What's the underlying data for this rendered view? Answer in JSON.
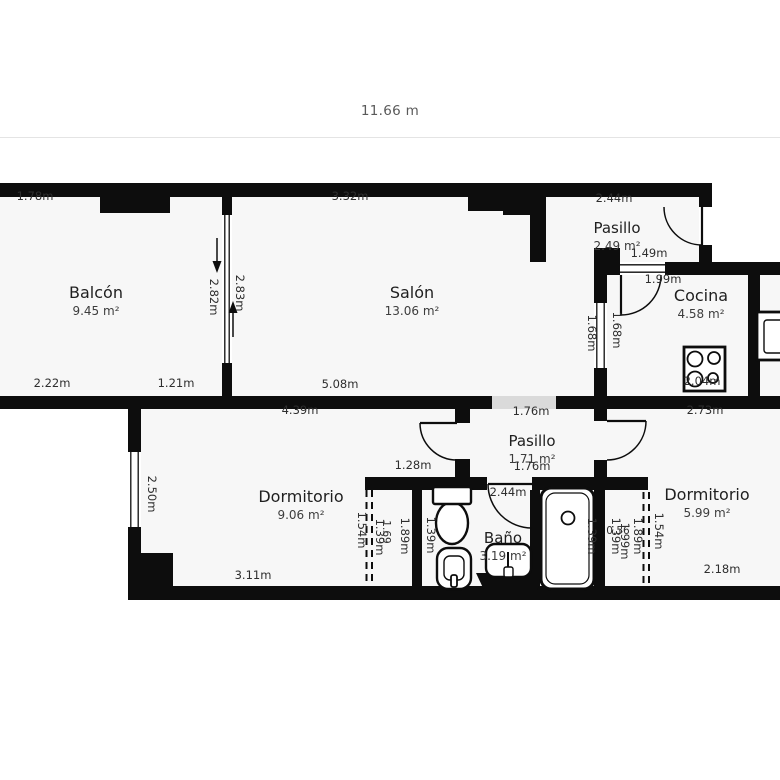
{
  "scale": {
    "label": "11.66 m"
  },
  "colors": {
    "wall": "#0d0d0d",
    "room_fill": "#f7f7f7",
    "background": "#ffffff",
    "opening": "#dadada",
    "dim_text": "#2e2e2e",
    "scale_line": "#e4e4e4",
    "scale_text": "#5a5a5a"
  },
  "plan": {
    "fills": [
      [
        0,
        196,
        712,
        200
      ],
      [
        594,
        262,
        186,
        141
      ],
      [
        128,
        396,
        652,
        204
      ]
    ],
    "opening": [
      492,
      396,
      64,
      13
    ],
    "walls": [
      [
        0,
        183,
        712,
        14
      ],
      [
        100,
        196,
        70,
        17
      ],
      [
        468,
        183,
        78,
        28
      ],
      [
        503,
        197,
        43,
        18
      ],
      [
        530,
        197,
        16,
        65
      ],
      [
        222,
        197,
        10,
        199
      ],
      [
        699,
        183,
        13,
        92
      ],
      [
        594,
        248,
        26,
        14
      ],
      [
        594,
        262,
        186,
        13
      ],
      [
        594,
        262,
        13,
        141
      ],
      [
        748,
        262,
        12,
        141
      ],
      [
        0,
        396,
        780,
        13
      ],
      [
        128,
        409,
        13,
        191
      ],
      [
        128,
        553,
        45,
        33
      ],
      [
        128,
        586,
        652,
        14
      ],
      [
        455,
        409,
        15,
        14
      ],
      [
        455,
        459,
        15,
        18
      ],
      [
        594,
        409,
        13,
        12
      ],
      [
        594,
        460,
        13,
        17
      ],
      [
        365,
        477,
        57,
        13
      ],
      [
        412,
        490,
        10,
        96
      ],
      [
        422,
        477,
        65,
        13
      ],
      [
        532,
        477,
        116,
        13
      ],
      [
        530,
        490,
        10,
        96
      ],
      [
        594,
        490,
        11,
        96
      ]
    ],
    "windows": [
      {
        "r": [
          222,
          215,
          10,
          148
        ],
        "dir": "v"
      },
      {
        "r": [
          128,
          452,
          13,
          75
        ],
        "dir": "v"
      },
      {
        "r": [
          594,
          303,
          13,
          65
        ],
        "dir": "v"
      },
      {
        "r": [
          620,
          262,
          45,
          13
        ],
        "dir": "h"
      },
      {
        "r": [
          699,
          207,
          13,
          38
        ],
        "dir": "none"
      }
    ],
    "doors": [
      {
        "leaf": [
          702,
          207,
          702,
          246
        ],
        "arc": "M 664 207 A 38 38 0 0 0 702 245"
      },
      {
        "leaf": [
          621,
          275,
          621,
          315
        ],
        "arc": "M 621 315 A 40 40 0 0 0 661 275"
      },
      {
        "leaf": [
          457,
          423,
          420,
          423
        ],
        "arc": "M 420 423 A 37 37 0 0 0 457 460"
      },
      {
        "leaf": [
          607,
          421,
          646,
          421
        ],
        "arc": "M 646 421 A 39 39 0 0 1 607 460"
      },
      {
        "leaf": [
          532,
          484,
          488,
          484
        ],
        "arc": "M 488 484 A 44 44 0 0 0 532 528"
      }
    ],
    "dashed": [
      [
        366.5,
        490,
        586
      ],
      [
        372,
        490,
        586
      ],
      [
        643.5,
        492,
        586
      ],
      [
        649,
        492,
        586
      ]
    ],
    "arrows": [
      {
        "x": 217,
        "y1": 238,
        "y2": 262,
        "tip": 273
      },
      {
        "x": 233,
        "y1": 337,
        "y2": 312,
        "tip": 301
      }
    ],
    "fixtures": [
      {
        "type": "toilet",
        "name": "toilet-icon",
        "rect": [
          433,
          487,
          38,
          58
        ]
      },
      {
        "type": "bidet",
        "name": "bidet-icon",
        "rect": [
          437,
          548,
          34,
          41
        ]
      },
      {
        "type": "washbasin",
        "name": "washbasin-icon",
        "rect": [
          476,
          544,
          69,
          46
        ]
      },
      {
        "type": "bathtub",
        "name": "bathtub-icon",
        "rect": [
          541,
          488,
          53,
          101
        ]
      },
      {
        "type": "stove",
        "name": "stove-icon",
        "rect": [
          684,
          347,
          41,
          44
        ]
      },
      {
        "type": "sink",
        "name": "kitchen-sink-icon",
        "rect": [
          757,
          312,
          34,
          48
        ]
      }
    ]
  },
  "rooms": [
    {
      "id": "balcon",
      "name": "Balcón",
      "area": "9.45 m²",
      "x": 96,
      "y": 298,
      "fs": 16
    },
    {
      "id": "salon",
      "name": "Salón",
      "area": "13.06 m²",
      "x": 412,
      "y": 298,
      "fs": 16
    },
    {
      "id": "pasillo-superior",
      "name": "Pasillo",
      "area": "2.49 m²",
      "x": 617,
      "y": 233,
      "fs": 15
    },
    {
      "id": "cocina",
      "name": "Cocina",
      "area": "4.58 m²",
      "x": 701,
      "y": 301,
      "fs": 16
    },
    {
      "id": "pasillo-inferior",
      "name": "Pasillo",
      "area": "1.71 m²",
      "x": 532,
      "y": 446,
      "fs": 15
    },
    {
      "id": "dormitorio-izquierdo",
      "name": "Dormitorio",
      "area": "9.06 m²",
      "x": 301,
      "y": 502,
      "fs": 16
    },
    {
      "id": "bano",
      "name": "Baño",
      "area": "3.19 m²",
      "x": 503,
      "y": 543,
      "fs": 15
    },
    {
      "id": "dormitorio-derecho",
      "name": "Dormitorio",
      "area": "5.99 m²",
      "x": 707,
      "y": 500,
      "fs": 16
    }
  ],
  "dims": [
    {
      "t": "1.78m",
      "x": 35,
      "y": 200
    },
    {
      "t": "3.32m",
      "x": 350,
      "y": 200
    },
    {
      "t": "2.44m",
      "x": 614,
      "y": 202
    },
    {
      "t": "1.49m",
      "x": 649,
      "y": 257
    },
    {
      "t": "2.82m",
      "x": 210,
      "y": 297,
      "r": 1
    },
    {
      "t": "2.83m",
      "x": 236,
      "y": 293,
      "r": 1
    },
    {
      "t": "1.99m",
      "x": 663,
      "y": 283
    },
    {
      "t": "1.68m",
      "x": 588,
      "y": 333,
      "r": 1
    },
    {
      "t": "1.68m",
      "x": 613,
      "y": 330,
      "r": 1
    },
    {
      "t": "2.04m",
      "x": 702,
      "y": 385
    },
    {
      "t": "2.22m",
      "x": 52,
      "y": 387
    },
    {
      "t": "1.21m",
      "x": 176,
      "y": 387
    },
    {
      "t": "5.08m",
      "x": 340,
      "y": 388
    },
    {
      "t": "4.39m",
      "x": 300,
      "y": 414
    },
    {
      "t": "1.76m",
      "x": 531,
      "y": 415
    },
    {
      "t": "2.73m",
      "x": 705,
      "y": 414
    },
    {
      "t": "1.76m",
      "x": 532,
      "y": 470
    },
    {
      "t": "1.28m",
      "x": 413,
      "y": 469
    },
    {
      "t": "2.44m",
      "x": 508,
      "y": 496
    },
    {
      "t": "2.50m",
      "x": 148,
      "y": 494,
      "r": 1
    },
    {
      "t": "1.54m",
      "x": 358,
      "y": 530,
      "r": 1
    },
    {
      "t": "1.39m",
      "x": 376,
      "y": 537,
      "r": 1
    },
    {
      "t": "1.69",
      "x": 383,
      "y": 532,
      "r": 1,
      "fs": 10.5
    },
    {
      "t": "1.89m",
      "x": 401,
      "y": 536,
      "r": 1
    },
    {
      "t": "1.39m",
      "x": 427,
      "y": 535,
      "r": 1
    },
    {
      "t": "1.39m",
      "x": 588,
      "y": 536,
      "r": 1
    },
    {
      "t": "1.39m",
      "x": 612,
      "y": 536,
      "r": 1
    },
    {
      "t": "0.56",
      "x": 618,
      "y": 534,
      "fs": 10.5
    },
    {
      "t": "1.99m",
      "x": 621,
      "y": 541,
      "r": 1
    },
    {
      "t": "1.89m",
      "x": 634,
      "y": 536,
      "r": 1
    },
    {
      "t": "1.54m",
      "x": 655,
      "y": 531,
      "r": 1
    },
    {
      "t": "3.11m",
      "x": 253,
      "y": 579
    },
    {
      "t": "2.18m",
      "x": 722,
      "y": 573
    }
  ]
}
